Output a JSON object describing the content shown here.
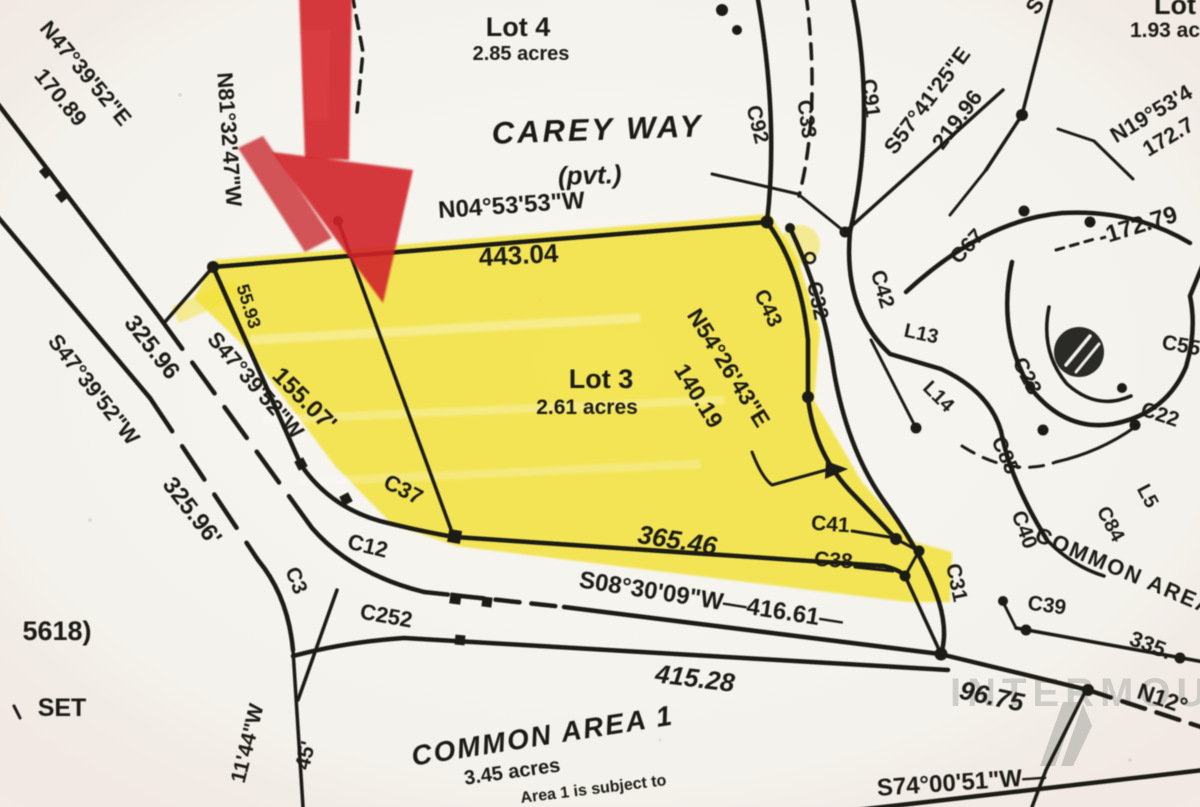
{
  "document": {
    "kind": "scanned plat map",
    "highlighted_parcel": "Lot 3",
    "colors": {
      "paper": "#f5f3ee",
      "ink": "#1b1a17",
      "highlight_yellow": "#f2e135",
      "arrow_red": "#d0232a",
      "watermark_gray": "#c6c4bf"
    }
  },
  "labels": {
    "lot4_name": "Lot 4",
    "lot4_area": "2.85 acres",
    "street": "CAREY WAY",
    "street_type": "(pvt.)",
    "brg_n04": "N04°53'53\"W",
    "len_443": "443.04",
    "lot3_name": "Lot 3",
    "lot3_area": "2.61 acres",
    "brg_n54": "N54°26'43\"E",
    "len_140": "140.19",
    "brg_n47": "N47°39'52\"E",
    "len_170": "170.89",
    "brg_n81": "N81°32'47\"W",
    "len_325a": "325.96",
    "brg_s47a": "S47°39'52\"W",
    "brg_s47b": "S47°39'52\"W",
    "len_325b": "325.96'",
    "len_155": "155.07'",
    "len_55": "55.93",
    "c37": "C37",
    "c12": "C12",
    "c3": "C3",
    "c252": "C252",
    "len_365": "365.46",
    "brg_s08": "S08°30'09\"W—416.61—",
    "len_415": "415.28",
    "common1": "COMMON AREA 1",
    "common1_area": "3.45 acres",
    "note": "Area 1 is subject to",
    "len_96": "96.75",
    "brg_s74": "S74°00'51\"W—",
    "brg_n12": "N12°",
    "c41": "C41",
    "c38": "C38",
    "c31": "C31",
    "c39": "C39",
    "c40": "C40",
    "c84": "C84",
    "l5": "L5",
    "c22": "C22",
    "len_335": "335.",
    "common_right": "COMMON AREA",
    "c85": "C85",
    "c23": "C23",
    "l14": "L14",
    "l13": "L13",
    "c42": "C42",
    "c43": "C43",
    "c32": "C32",
    "c67": "C67",
    "c91": "C91",
    "c33": "C33",
    "c92": "C92",
    "c55": "C55",
    "len_17279": "-172.79",
    "brg_s57": "S57°41'25\"E",
    "len_219": "219.96",
    "brg_n19": "N19°53'4",
    "len_1727": "172.7",
    "frag_s": "S",
    "lot_tr_name": "Lot",
    "lot_tr_area": "1.93 ac",
    "ref_5618": "5618)",
    "set_mark": "SET",
    "brg_n11": "11'44\"W",
    "len_45": "45'",
    "watermark": "INTERMOUNTAIN"
  }
}
